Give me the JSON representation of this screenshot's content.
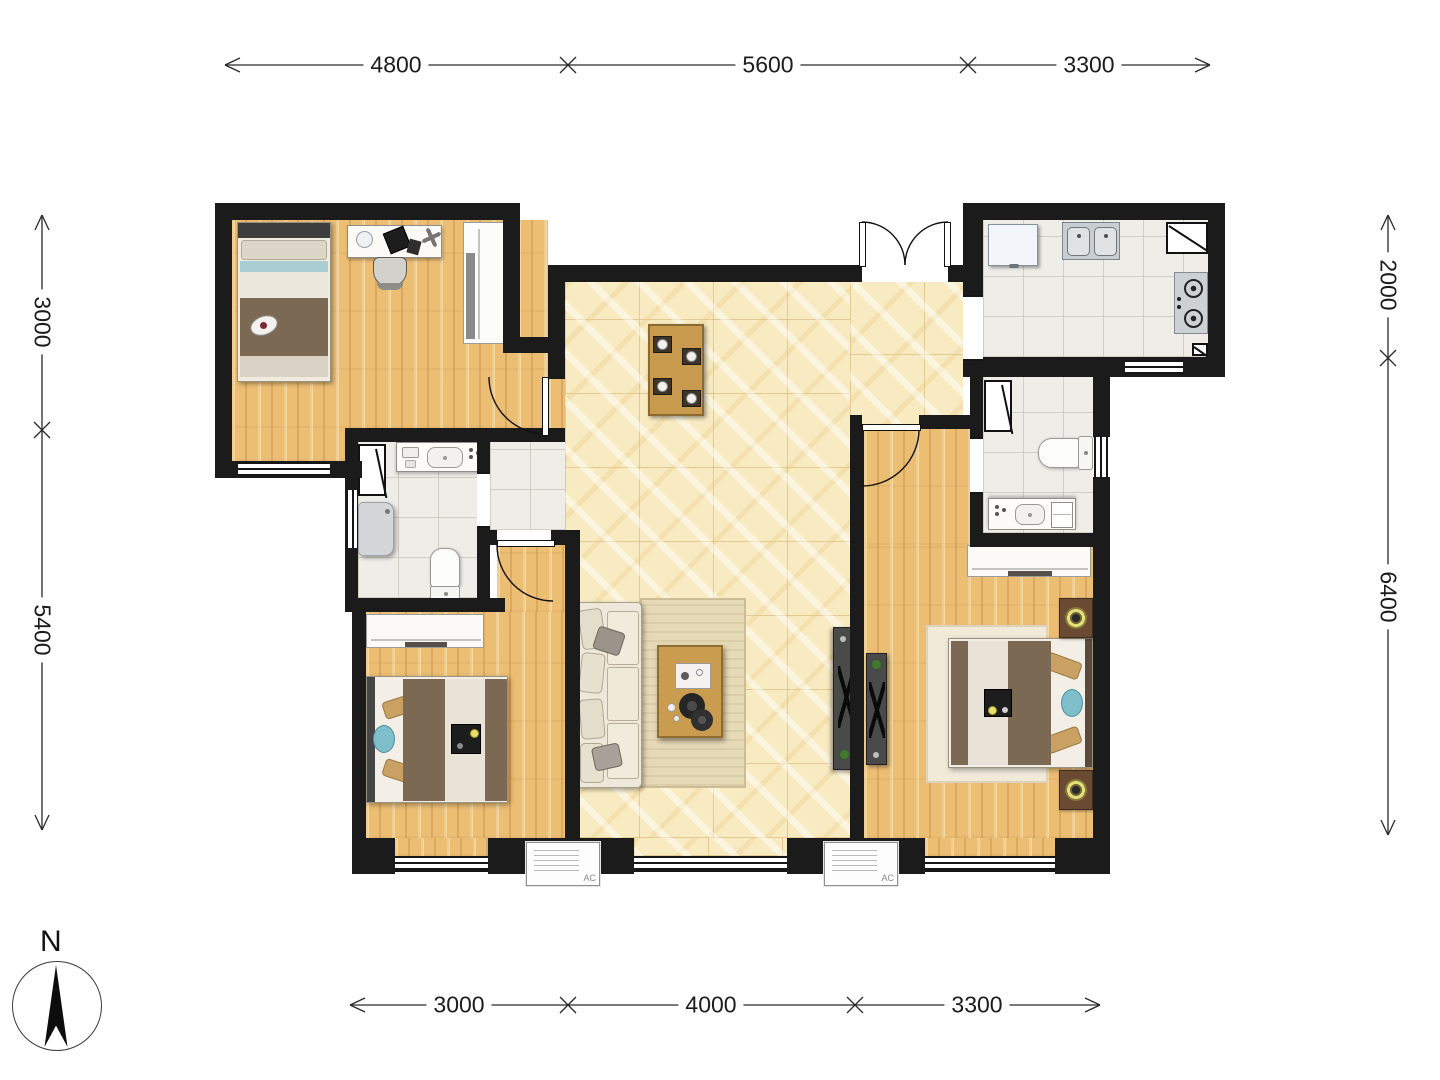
{
  "title": "apartment-floor-plan",
  "dimensions": {
    "top": [
      "4800",
      "5600",
      "3300"
    ],
    "bottom": [
      "3000",
      "4000",
      "3300"
    ],
    "left": [
      "3000",
      "5400"
    ],
    "right": [
      "2000",
      "6400"
    ]
  },
  "compass": {
    "label": "N"
  },
  "ac_units": [
    "AC",
    "AC"
  ],
  "colors": {
    "wall": "#1b1b1b",
    "wood_floor": "#ecbe74",
    "tile_cream": "#f8ebc2",
    "tile_white": "#efede8",
    "dim_line": "#2a2a2a"
  }
}
